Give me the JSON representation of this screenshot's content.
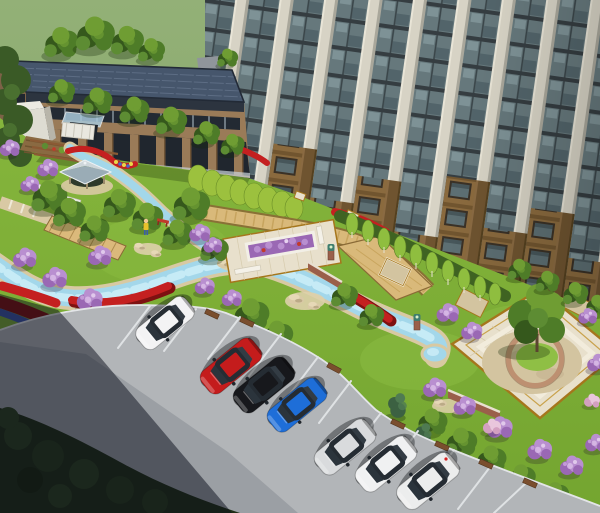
{
  "meta": {
    "kind": "aerial 3d architectural rendering",
    "subject": "residential courtyard landscape with high-rise tower, low-rise clubhouse, gardens, stream and street parking"
  },
  "palette": {
    "hill-top": "#93b077",
    "hill-bottom": "#7da25f",
    "lawn": "#7fb13a",
    "lawn-bright": "#8fbf45",
    "road": "#b2b5b8",
    "road-lane": "#9b9fa4",
    "curb": "#e3e5e7",
    "dark-planting": "#202e16",
    "water": "#a3d7ea",
    "water-core": "#cdeef8",
    "water-bank": "#d8c9a2",
    "tower-glass": "#66787c",
    "tower-pier": "#d7d3c5",
    "tower-pier-shade": "#a9a79b",
    "tower-brick": "#8a6a3e",
    "tower-frame": "#353d41",
    "low-roof": "#46566c",
    "low-roof-line": "#5d6d84",
    "low-brick": "#9a7b58",
    "low-window": "#20262e",
    "annex-white": "#dedcd2",
    "canopy-glass": "#a8c8da",
    "tree-green": "#4e7c28",
    "tree-mid": "#5d8c33",
    "tree-light": "#6f9d33",
    "tree-dark": "#35581c",
    "hedge": "#9cc13e",
    "hedge-dark": "#3f6322",
    "conifer": "#3c6142",
    "flower-red": "#c42020",
    "flower-red-dark": "#7e1111",
    "flower-purple": "#9a68b4",
    "flower-purple-light": "#b98fd0",
    "flower-blue": "#3d55a8",
    "flower-pink": "#d3a0c0",
    "path-tan": "#d9c9a4",
    "path-gold": "#d9b97a",
    "path-border": "#8a6a36",
    "plaza-pave": "#e8e0cc",
    "plaza-trim": "#a5761c",
    "pebble": "#d3c4a0",
    "seat-wall": "#bd9071",
    "brick-wall": "#9a5f4a",
    "boulder": "#d9c9a6",
    "pavilion-roof-light": "#cdd6da",
    "pavilion-roof-dark": "#9aacb6",
    "car-glass": "#252c33"
  },
  "buildings": [
    {
      "id": "tower",
      "label": "high-rise residential tower, cream piers with brown brick bays"
    },
    {
      "id": "lowrise",
      "label": "low-rise clubhouse with dark blue panel roof"
    },
    {
      "id": "pavilion",
      "label": "garden pavilion with gray hip roof"
    }
  ],
  "vehicles": [
    {
      "label": "white wagon",
      "color": "#f3f3f4"
    },
    {
      "label": "red sedan",
      "color": "#c41c1c"
    },
    {
      "label": "black sedan",
      "color": "#17181c"
    },
    {
      "label": "blue hatchback",
      "color": "#1e6ed8"
    },
    {
      "label": "silver hatchback",
      "color": "#d9dbdd"
    },
    {
      "label": "white sedan",
      "color": "#f0f1f2"
    },
    {
      "label": "white suv",
      "color": "#eceded"
    }
  ],
  "landscape_features": [
    "winding light-blue stream with sandy banks",
    "red and purple flower ribbons",
    "lilac shrub masses",
    "trimmed hedge rows",
    "wooden boardwalk bridge",
    "central plaza with purple planter and white benches",
    "diamond paved plaza with central tree and curved seat wall",
    "street parking with white stall lines and wood planter boxes",
    "dark shaded planting along lower road"
  ]
}
